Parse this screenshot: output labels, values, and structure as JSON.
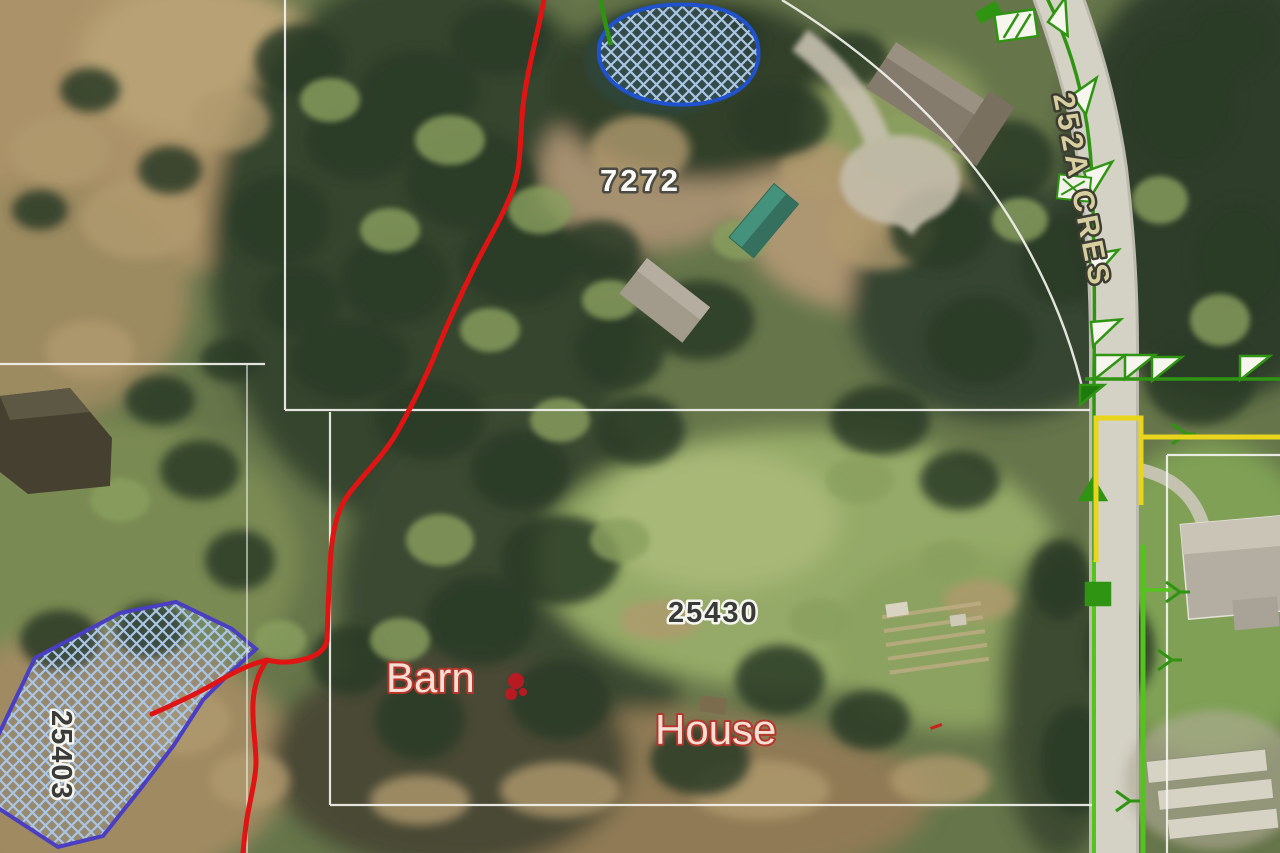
{
  "map_labels": {
    "parcels": [
      {
        "number": "7272"
      },
      {
        "number": "25430"
      },
      {
        "number": "25403"
      }
    ],
    "street": {
      "name": "252A CRES"
    },
    "buildings": {
      "barn": "Barn",
      "house": "House"
    }
  },
  "colors": {
    "parcel_line": "#f4f4ee",
    "creek": "#e11414",
    "wetland_outline_pond": "#1f52cc",
    "wetland_outline_left": "#4a3ec2",
    "wetland_hatch": "#aac6e6",
    "utility_green_dark": "#2f9412",
    "utility_green_bright": "#52c41c",
    "utility_yellow": "#e8d51c",
    "street_label_fill": "#d8cfa0",
    "address_label_light": "#fbfaf6",
    "address_label_dark": "#3a3a38",
    "building_label_fill": "#f6e0d6",
    "building_label_outline": "#b5372b",
    "road_surface": "#d4d1c5"
  }
}
